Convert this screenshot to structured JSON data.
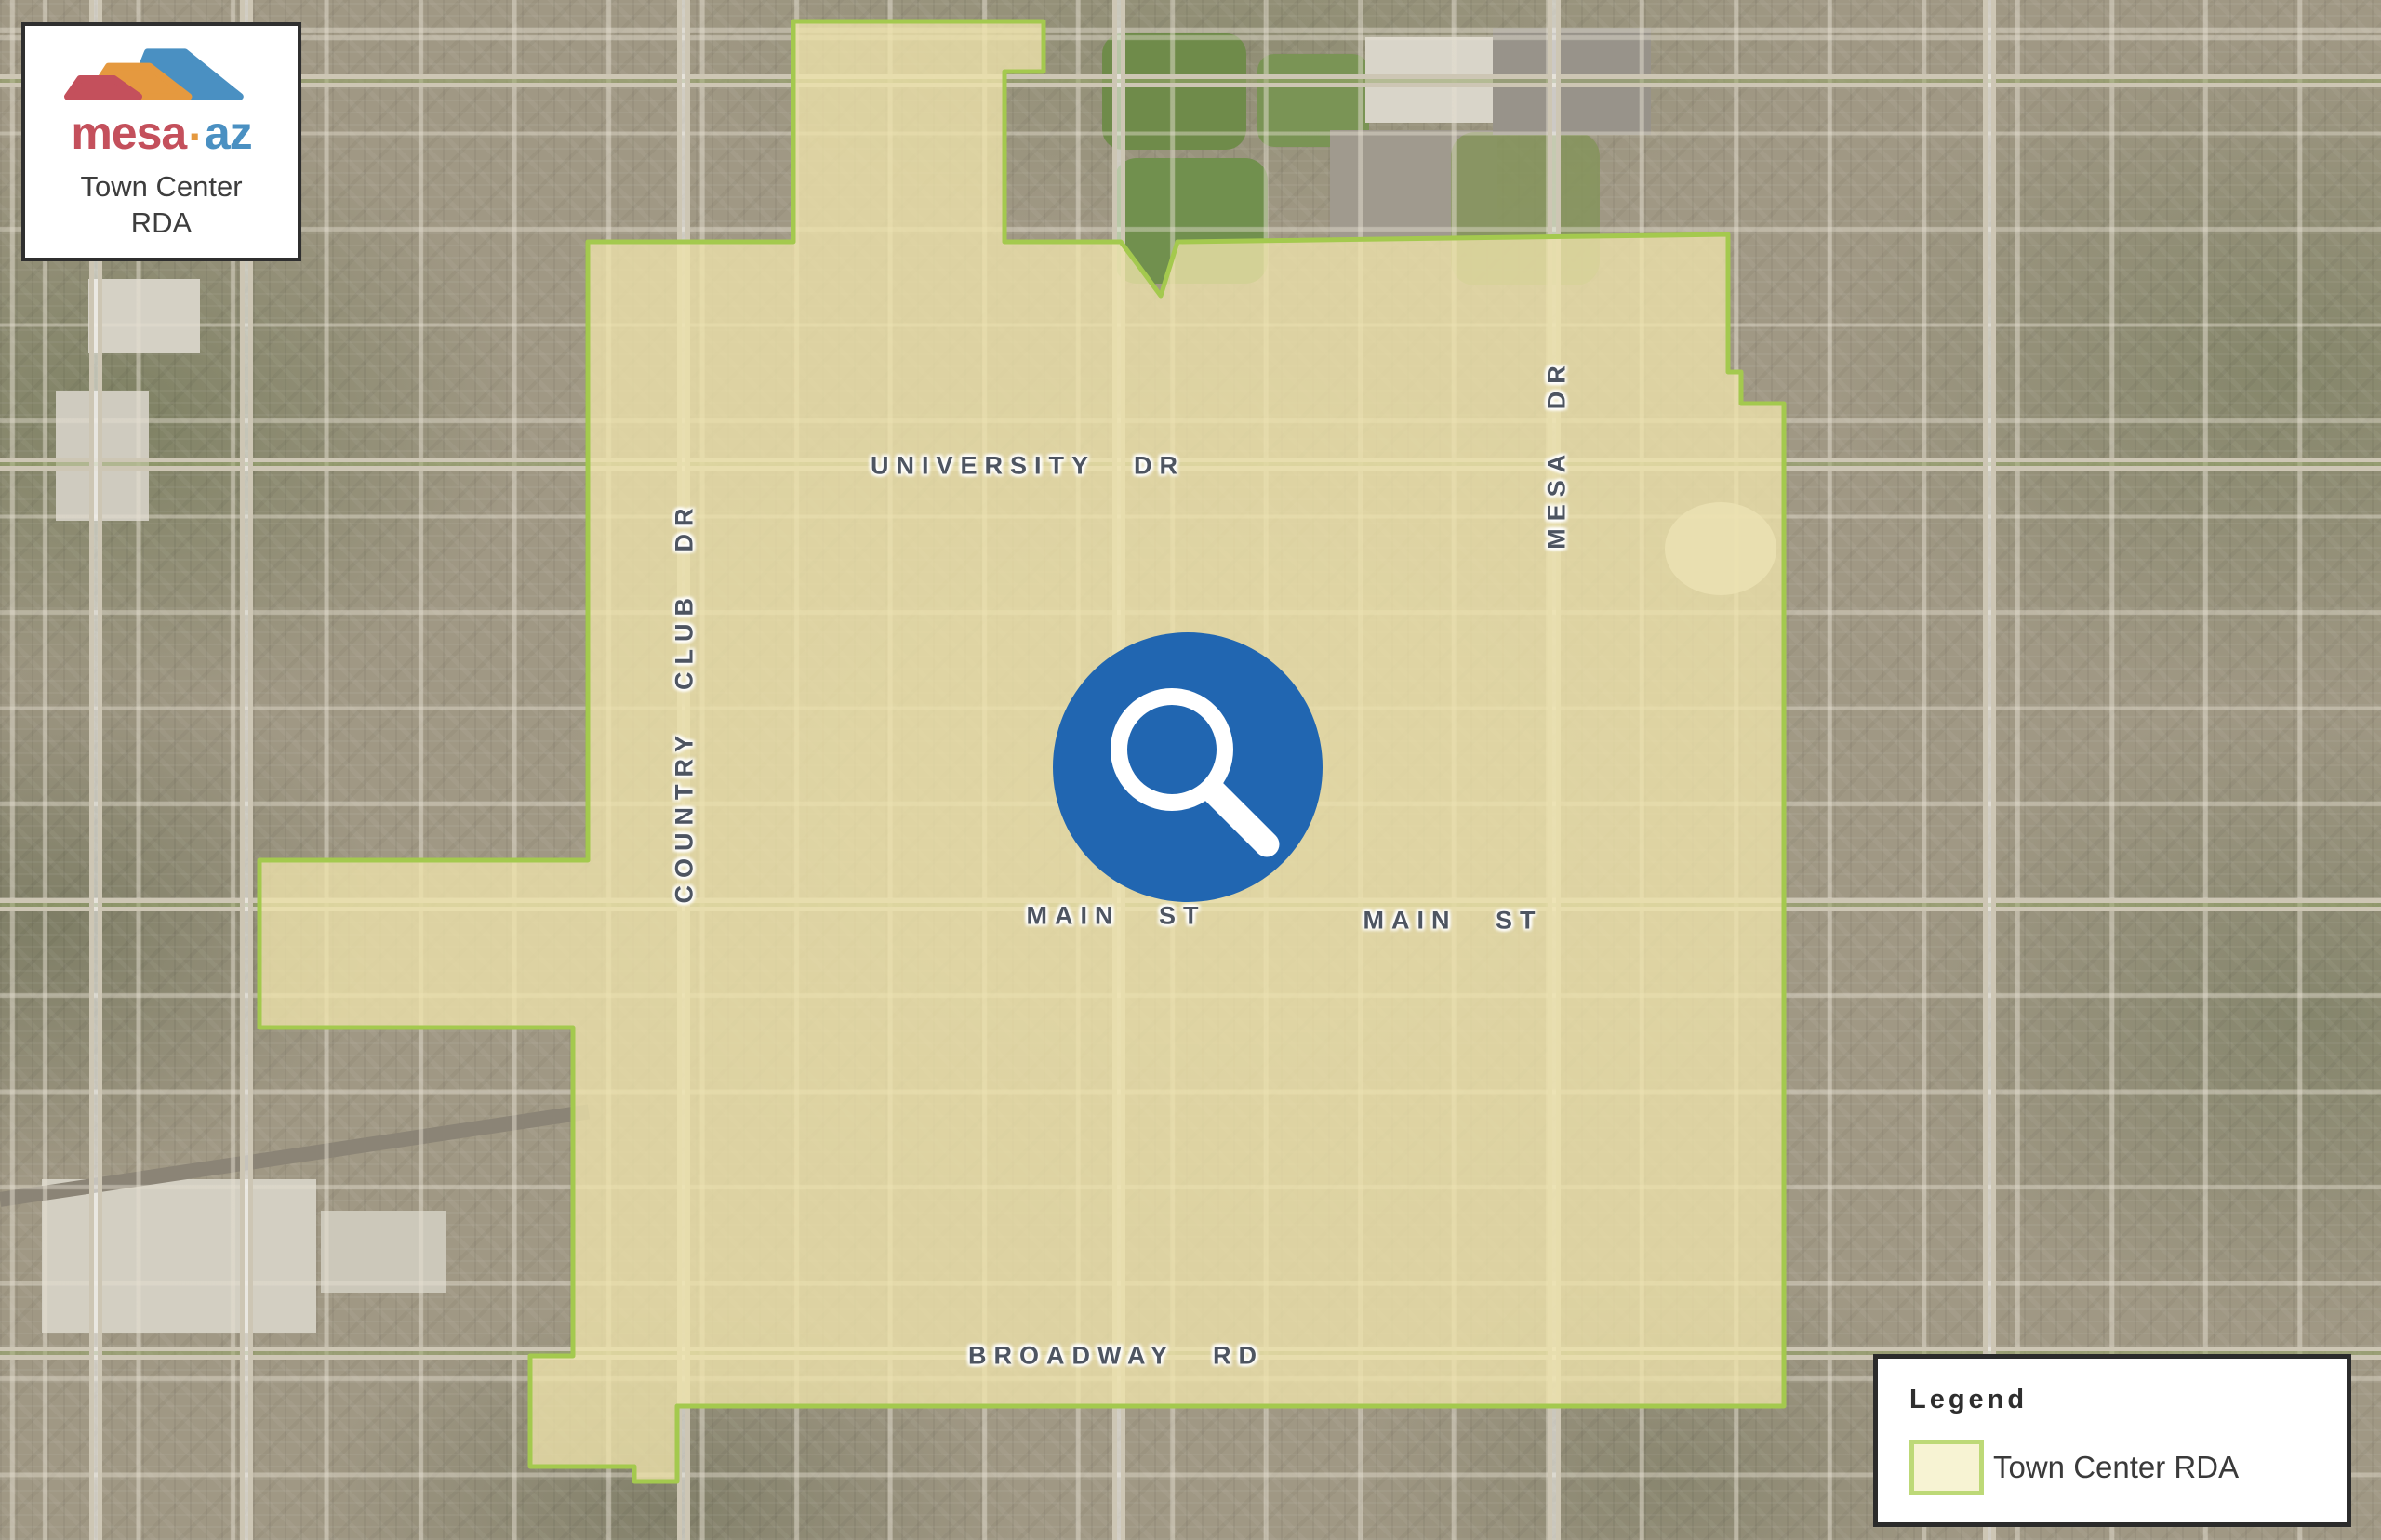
{
  "title_card": {
    "brand": {
      "mesa": "mesa",
      "dot": "·",
      "az": "az"
    },
    "subtitle_line1": "Town Center",
    "subtitle_line2": "RDA",
    "colors": {
      "red": "#c4505c",
      "orange": "#e5993f",
      "blue": "#4a90c2"
    }
  },
  "map": {
    "street_labels": [
      {
        "name": "university-dr",
        "text": "UNIVERSITY DR"
      },
      {
        "name": "country-club-dr",
        "text": "COUNTRY CLUB DR"
      },
      {
        "name": "mesa-dr",
        "text": "MESA DR"
      },
      {
        "name": "main-st-west",
        "text": "MAIN ST"
      },
      {
        "name": "main-st-east",
        "text": "MAIN ST"
      },
      {
        "name": "broadway-rd",
        "text": "BROADWAY RD"
      }
    ],
    "rda_overlay": {
      "label": "Town Center RDA",
      "fill": "#eee3ab",
      "border": "#a4c94e"
    },
    "search_marker": {
      "color": "#2166b1"
    }
  },
  "legend": {
    "title": "Legend",
    "items": [
      {
        "label": "Town Center RDA",
        "swatch_fill": "#f7f3d3",
        "swatch_border": "#bdd977"
      }
    ]
  }
}
